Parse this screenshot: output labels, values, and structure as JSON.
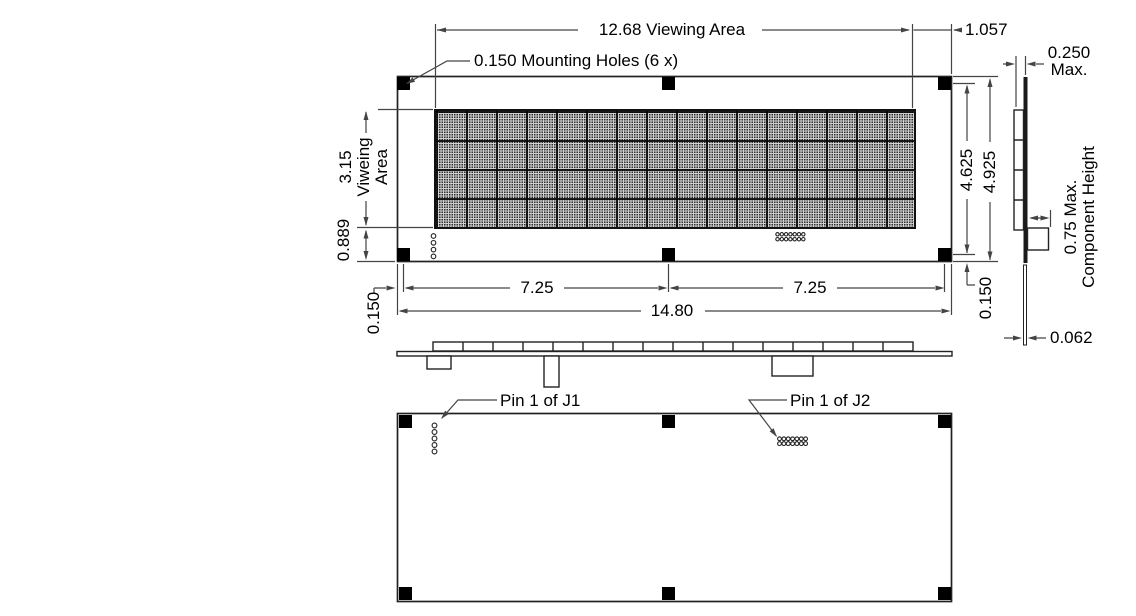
{
  "drawing": {
    "top": {
      "viewing_width": "12.68 Viewing Area",
      "mounting_holes": "0.150 Mounting Holes (6 x)",
      "edge_offset": "1.057"
    },
    "left": {
      "viewing_height": "3.15",
      "viewing_word1": "Viweing",
      "viewing_word2": "Area",
      "bottom_margin": "0.889",
      "hole_offset": "0.150"
    },
    "bottom": {
      "pitch_left": "7.25",
      "pitch_right": "7.25",
      "total_width": "14.80",
      "hole_offset_right": "0.150"
    },
    "right": {
      "hole_span": "4.625",
      "total_height": "4.925"
    },
    "side": {
      "thickness": "0.250",
      "thickness_qual": "Max.",
      "component_height": "0.75 Max.",
      "component_height_label": "Component Height",
      "pcb_thickness": "0.062"
    },
    "bottom_view": {
      "pin1_j1": "Pin 1 of J1",
      "pin1_j2": "Pin 1 of J2"
    }
  }
}
